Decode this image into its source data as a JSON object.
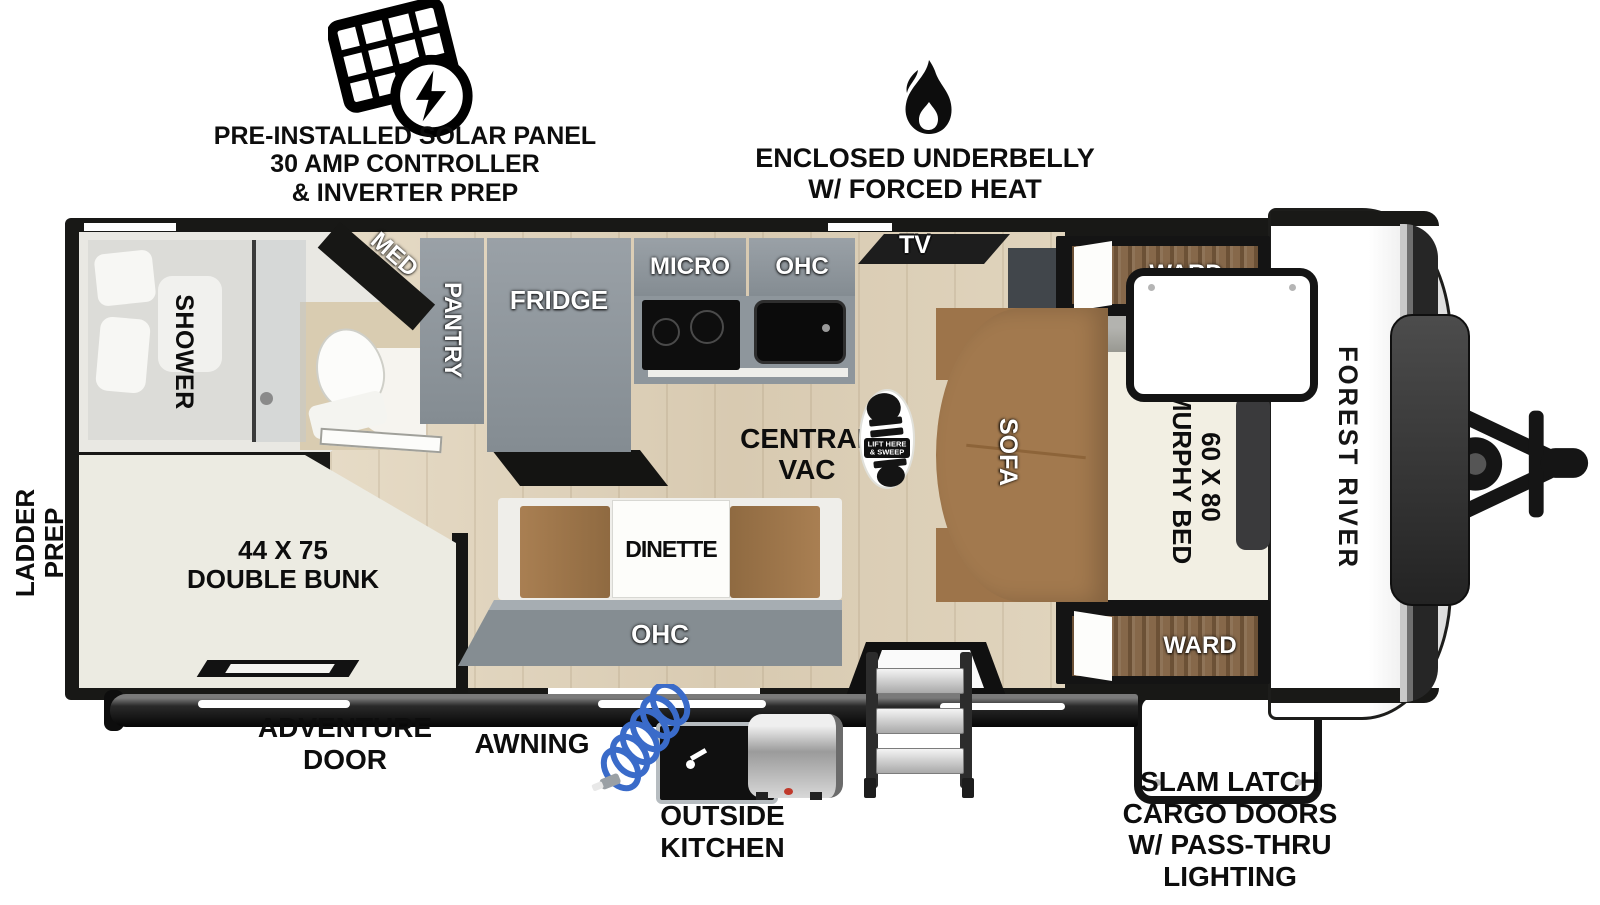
{
  "title": "Forest River travel trailer floorplan",
  "brand": "FOREST RIVER",
  "callouts": {
    "solar": {
      "lines": [
        "PRE-INSTALLED SOLAR PANEL",
        "30 AMP CONTROLLER",
        "& INVERTER PREP"
      ]
    },
    "underbelly": {
      "lines": [
        "ENCLOSED UNDERBELLY",
        "W/ FORCED HEAT"
      ]
    },
    "ladder_prep": {
      "lines": [
        "LADDER",
        "PREP"
      ]
    },
    "adventure_door": {
      "lines": [
        "ADVENTURE",
        "DOOR"
      ]
    },
    "awning": "AWNING",
    "outside_kitchen": {
      "lines": [
        "OUTSIDE",
        "KITCHEN"
      ]
    },
    "slam_latch": {
      "lines": [
        "SLAM LATCH",
        "CARGO DOORS",
        "W/ PASS-THRU",
        "LIGHTING"
      ]
    }
  },
  "rooms": {
    "shower": "SHOWER",
    "med_cabinet": "MED",
    "double_bunk": {
      "lines": [
        "44 X 75",
        "DOUBLE BUNK"
      ]
    },
    "pantry": "PANTRY",
    "fridge": "FRIDGE",
    "microwave": "MICRO",
    "kitchen_ohc": "OHC",
    "tv": "TV",
    "ward_top": "WARD",
    "ward_bottom": "WARD",
    "sofa": "SOFA",
    "murphy_bed": {
      "lines": [
        "60 X 80",
        "MURPHY BED"
      ]
    },
    "central_vac": {
      "lines": [
        "CENTRAL",
        "VAC"
      ]
    },
    "vac_sticker": {
      "lines": [
        "LIFT HERE",
        "& SWEEP"
      ]
    },
    "dinette": "DINETTE",
    "dinette_ohc": "OHC"
  },
  "colors": {
    "wall_black": "#181816",
    "floor_wood": "#dbcfb6",
    "cabinet_gray": "#8c949a",
    "sofa_brown": "#a2794e",
    "ward_wood": "#86684a",
    "bed_cream": "#f2efe3",
    "hose_blue": "#3a6bc9",
    "accent_red": "#c0392b"
  }
}
